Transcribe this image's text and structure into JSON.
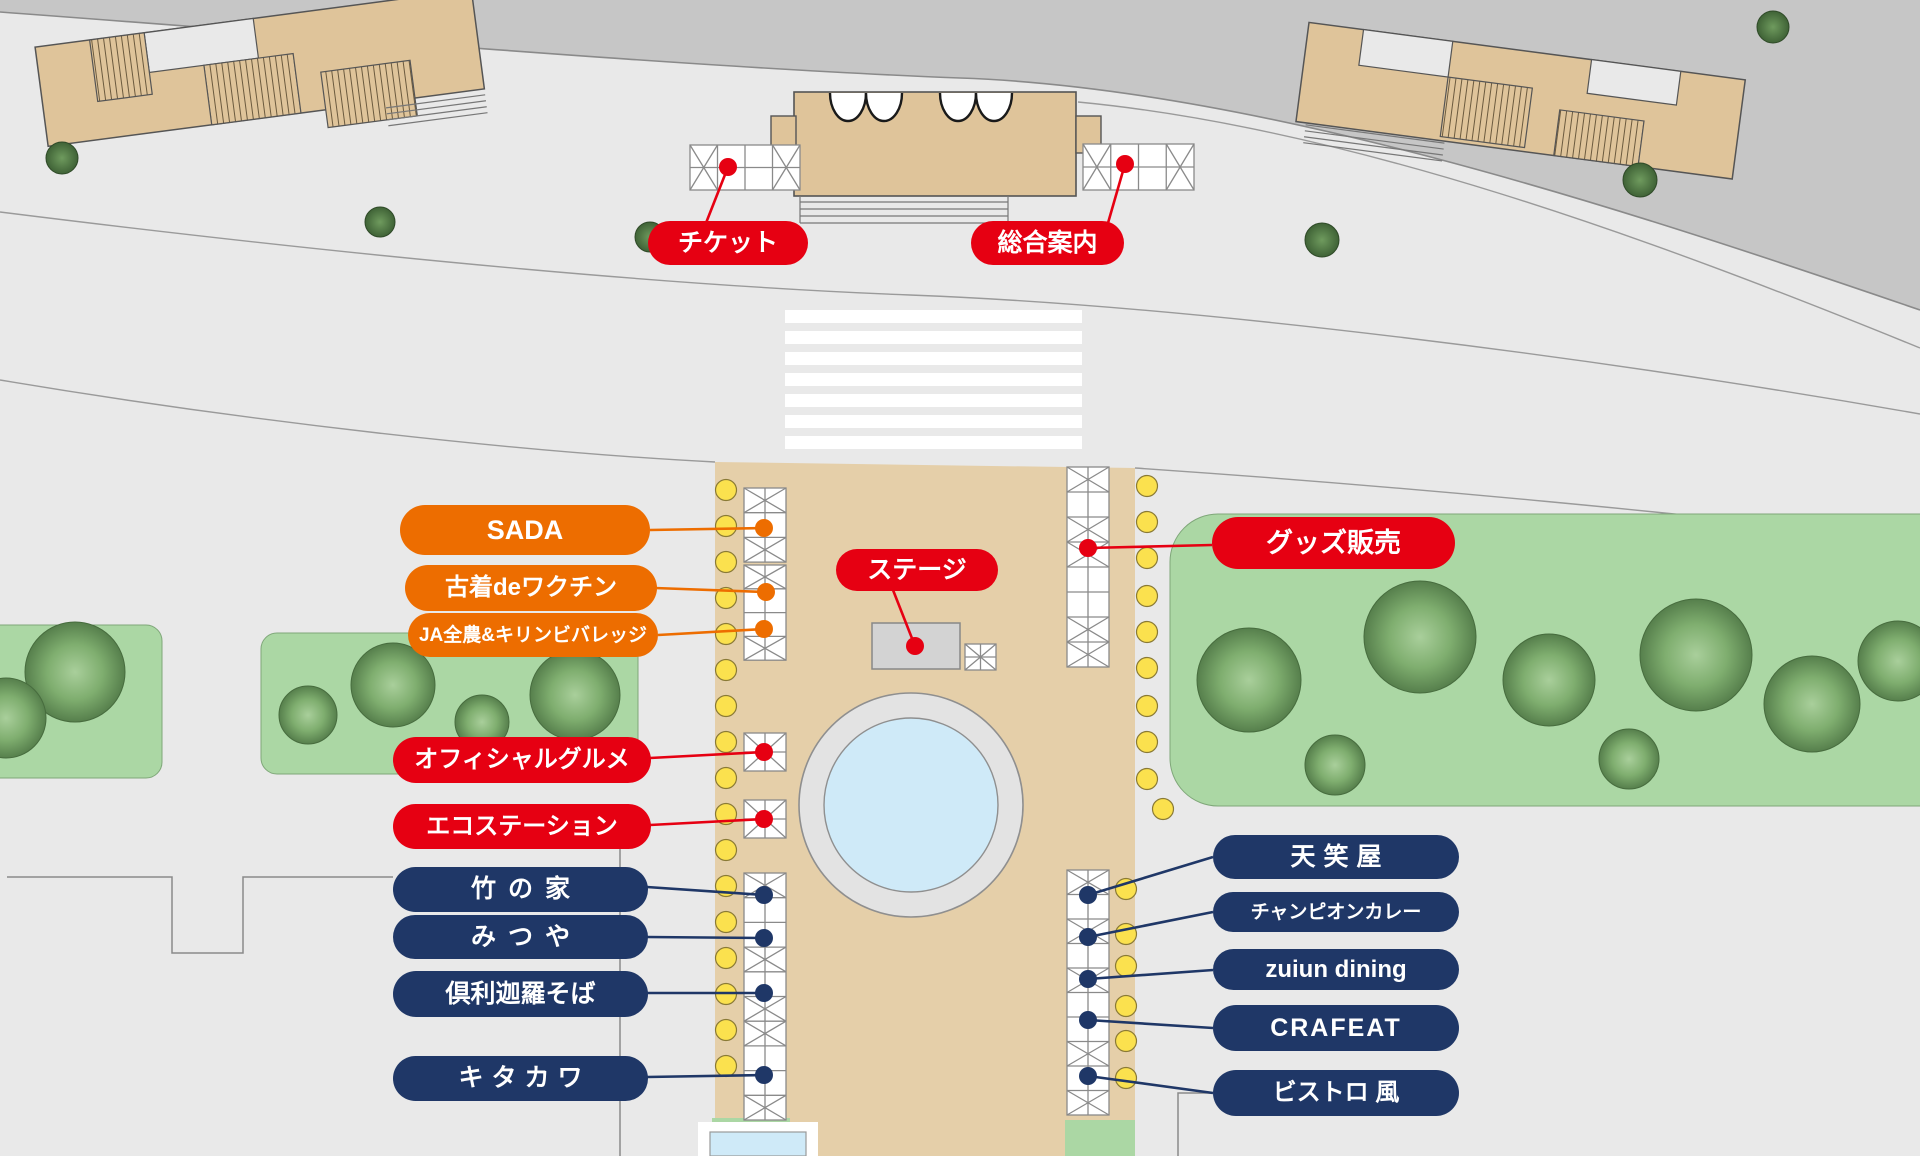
{
  "labels": {
    "ticket": "チケット",
    "info": "総合案内",
    "stage": "ステージ",
    "goods": "グッズ販売",
    "sada": "SADA",
    "furugi_vaccine": "古着deワクチン",
    "ja_zennoh_kirin": "JA全農&キリンビバレッジ",
    "official_gourmet": "オフィシャルグルメ",
    "eco_station": "エコステーション",
    "take_no_ie": "竹の家",
    "mitsuya": "みつや",
    "kurikara_soba": "倶利迦羅そば",
    "kitakawa": "キタカワ",
    "tenshoya": "天笑屋",
    "champion_curry": "チャンピオンカレー",
    "zuiun_dining": "zuiun dining",
    "crafeat": "CRAFEAT",
    "bistro_fuu": "ビストロ 風"
  },
  "colors": {
    "red": "#e60012",
    "orange": "#ed6d00",
    "navy": "#1f3767",
    "plaza_tan": "#e5cfa9",
    "building_tan": "#dfc49a",
    "road_gray": "#c6c6c6",
    "bg_gray": "#e9e9e9",
    "line_gray": "#8a8a8a",
    "grass_green": "#abd7a4",
    "marker_yellow": "#fbe14e",
    "pond_blue": "#cfeaf8",
    "stage_gray": "#d3d3d3",
    "tent_white": "#ffffff"
  }
}
